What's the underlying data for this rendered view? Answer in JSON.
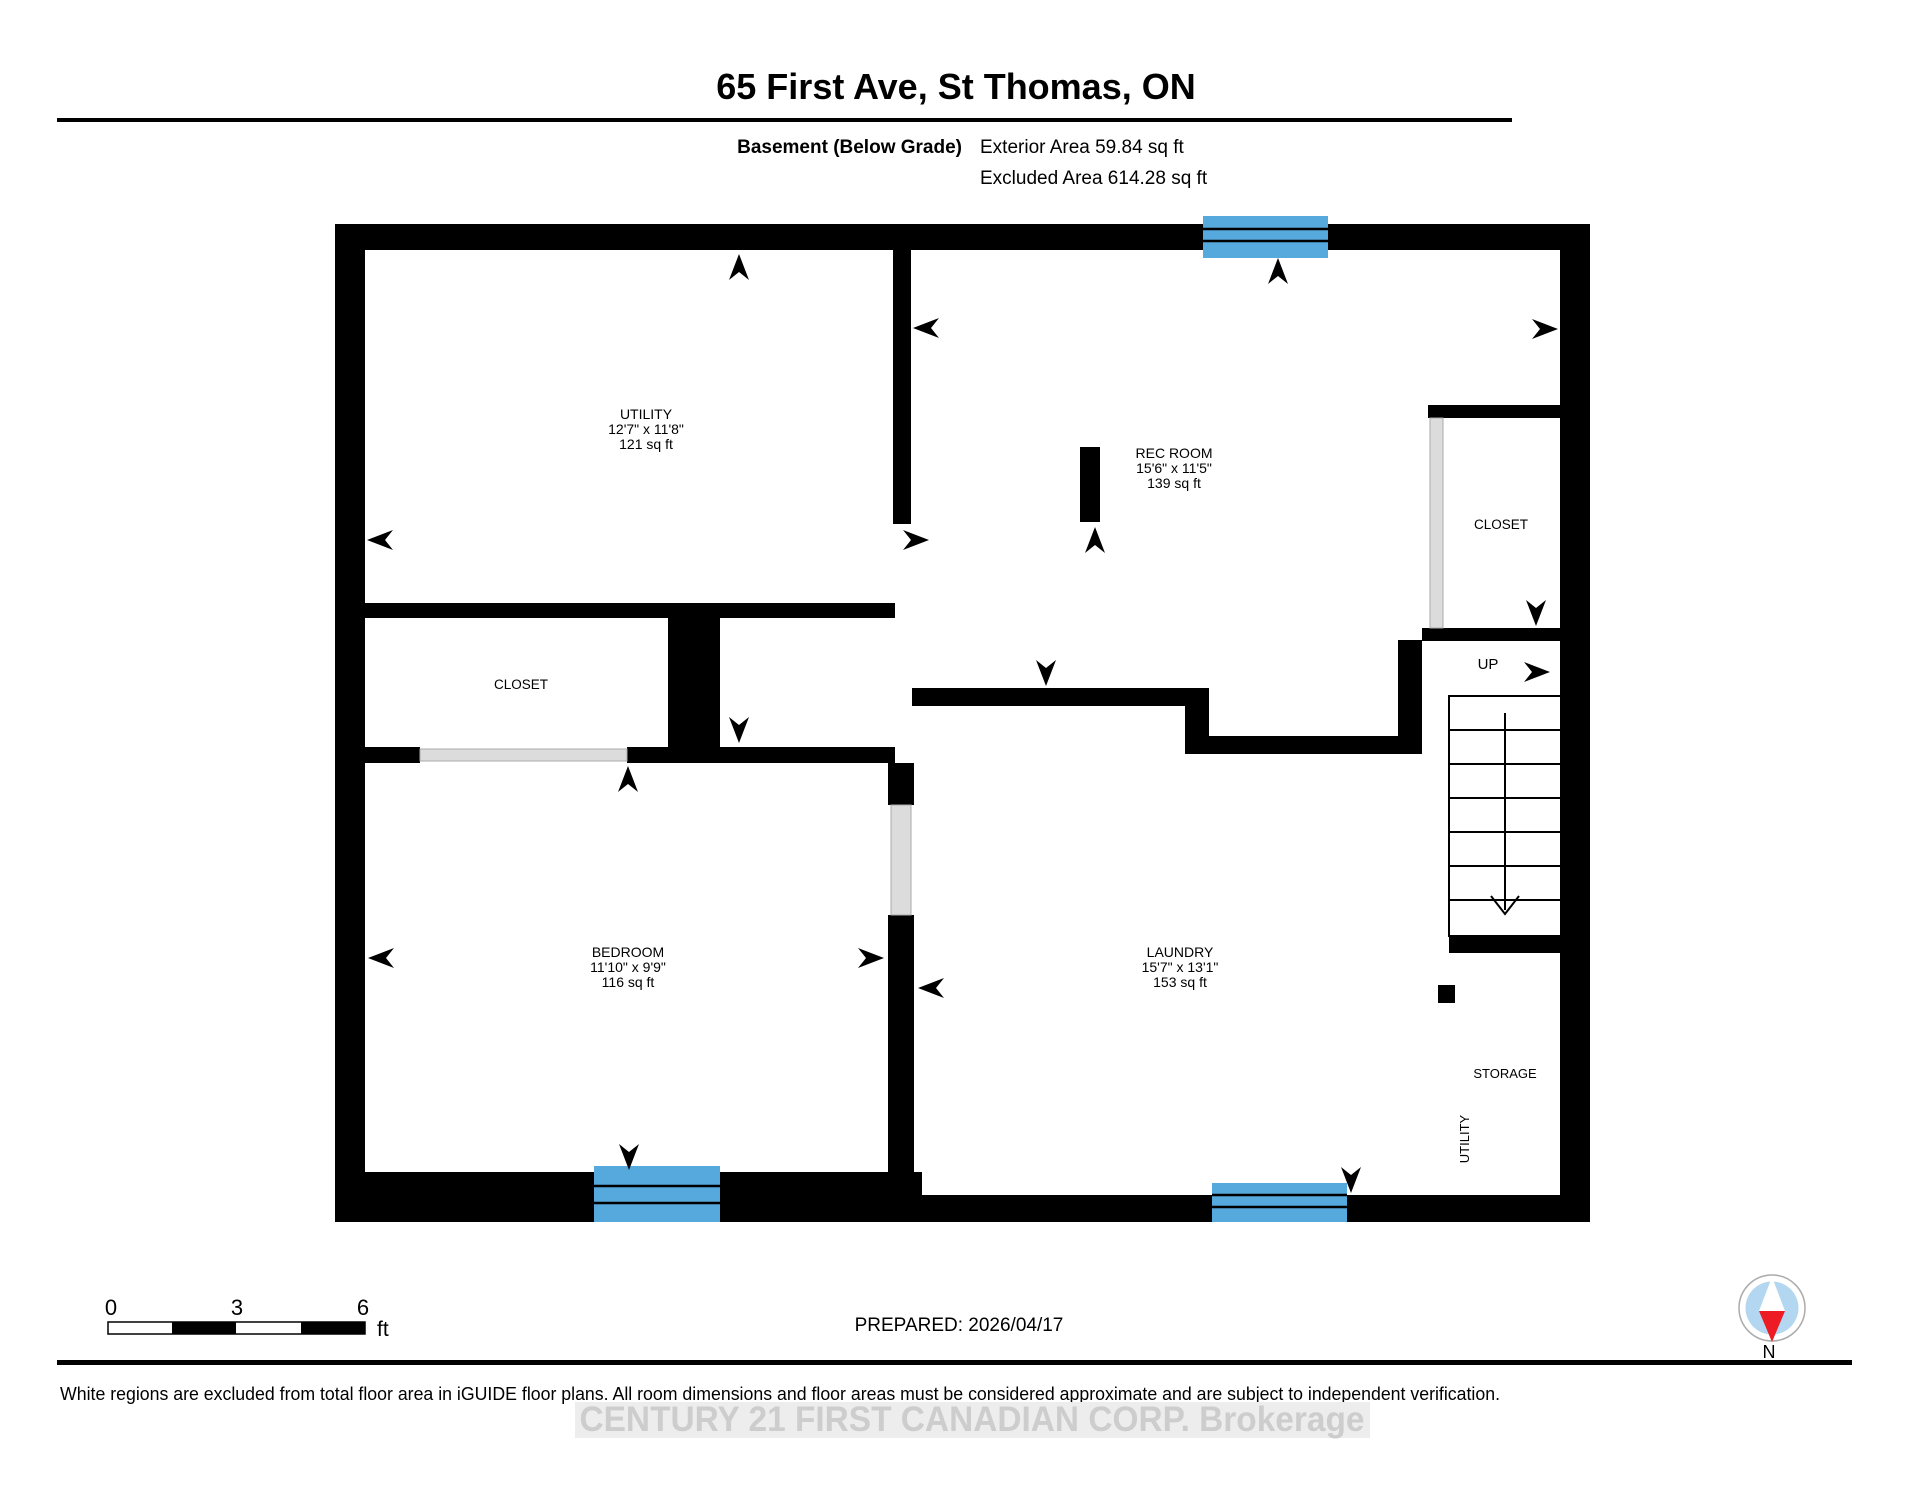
{
  "page": {
    "title": "65 First Ave, St Thomas, ON"
  },
  "subtitle": {
    "floor": "Basement (Below Grade)",
    "exterior": "Exterior Area 59.84 sq ft",
    "excluded": "Excluded Area 614.28 sq ft"
  },
  "rooms": {
    "utility": {
      "name": "UTILITY",
      "dims": "12'7\" x 11'8\"",
      "area": "121 sq ft"
    },
    "rec_room": {
      "name": "REC ROOM",
      "dims": "15'6\" x 11'5\"",
      "area": "139 sq ft"
    },
    "bedroom": {
      "name": "BEDROOM",
      "dims": "11'10\" x 9'9\"",
      "area": "116 sq ft"
    },
    "laundry": {
      "name": "LAUNDRY",
      "dims": "15'7\" x 13'1\"",
      "area": "153 sq ft"
    },
    "closet_left": {
      "name": "CLOSET"
    },
    "closet_right": {
      "name": "CLOSET"
    },
    "storage": {
      "name": "STORAGE"
    },
    "utility_small": {
      "name": "UTILITY"
    },
    "stairs": {
      "label": "UP"
    }
  },
  "scale_bar": {
    "tick0": "0",
    "tick1": "3",
    "tick2": "6",
    "unit": "ft"
  },
  "footer": {
    "prepared": "PREPARED: 2026/04/17",
    "disclaimer": "White regions are excluded from total floor area in iGUIDE floor plans. All room dimensions and floor areas must be considered approximate and are subject to independent verification.",
    "watermark": "CENTURY 21 FIRST CANADIAN CORP. Brokerage"
  },
  "compass": {
    "label": "N"
  },
  "colors": {
    "wall": "#000000",
    "window_blue": "#56a9dc",
    "door_gray": "#dcdcdc",
    "compass_blue": "#b3d7f0",
    "compass_red": "#ed1b24",
    "watermark_gray": "#cdcdcd"
  }
}
